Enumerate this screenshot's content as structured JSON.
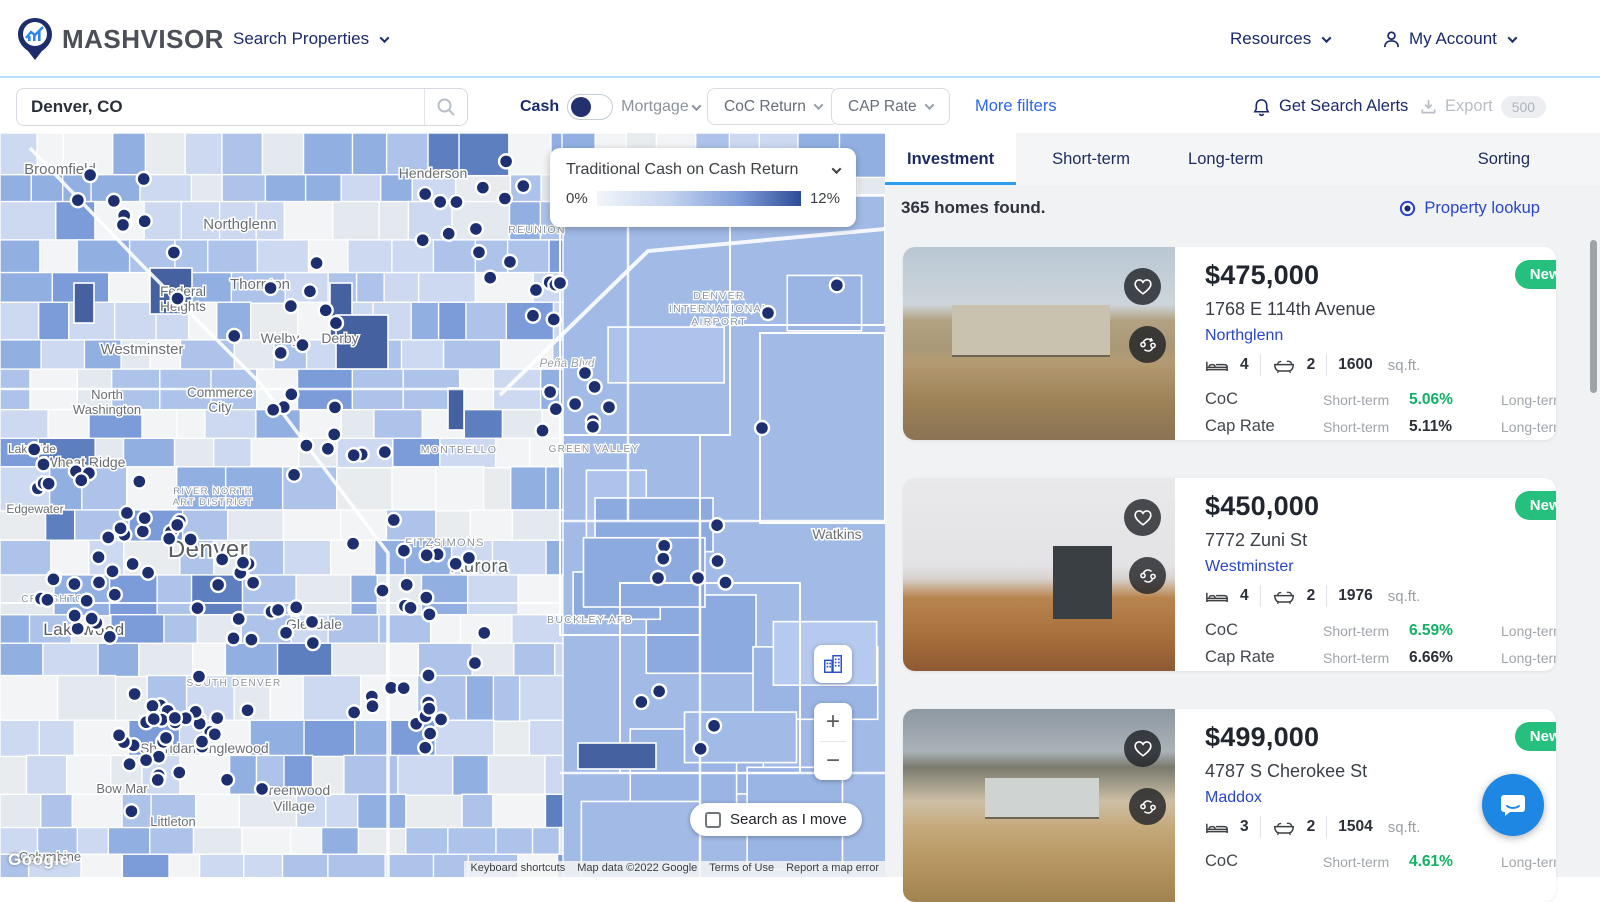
{
  "header": {
    "brand": "MASHVISOR",
    "search_properties": "Search Properties",
    "resources": "Resources",
    "my_account": "My Account"
  },
  "filters": {
    "search_value": "Denver, CO",
    "cash": "Cash",
    "mortgage": "Mortgage",
    "coc_return": "CoC Return",
    "cap_rate": "CAP Rate",
    "more_filters": "More filters",
    "get_search_alerts": "Get Search Alerts",
    "export": "Export",
    "export_count": "500"
  },
  "map": {
    "legend_title": "Traditional Cash on Cash Return",
    "legend_min": "0%",
    "legend_max": "12%",
    "search_as_i_move": "Search as I move",
    "zoom_in": "+",
    "zoom_out": "−",
    "google": "Google",
    "attribution": [
      "Keyboard shortcuts",
      "Map data ©2022 Google",
      "Terms of Use",
      "Report a map error"
    ],
    "labels": [
      {
        "t": "Broomfield",
        "x": 60,
        "y": 41,
        "s": 15,
        "k": "city"
      },
      {
        "t": "Henderson",
        "x": 433,
        "y": 45,
        "s": 14,
        "k": "city"
      },
      {
        "t": "REUNION",
        "x": 537,
        "y": 100,
        "s": 10.5,
        "k": "caps"
      },
      {
        "t": "Northglenn",
        "x": 240,
        "y": 96,
        "s": 15,
        "k": "city"
      },
      {
        "t": "Thornton",
        "x": 260,
        "y": 156,
        "s": 15,
        "k": "city"
      },
      {
        "t": "Federal",
        "x": 183,
        "y": 163,
        "s": 13.5,
        "k": "city"
      },
      {
        "t": "Heights",
        "x": 183,
        "y": 178,
        "s": 13.5,
        "k": "city"
      },
      {
        "t": "Welby",
        "x": 280,
        "y": 210,
        "s": 14,
        "k": "city"
      },
      {
        "t": "Derby",
        "x": 340,
        "y": 210,
        "s": 14,
        "k": "city"
      },
      {
        "t": "Westminster",
        "x": 142,
        "y": 221,
        "s": 15,
        "k": "city"
      },
      {
        "t": "North",
        "x": 107,
        "y": 266,
        "s": 13,
        "k": "city"
      },
      {
        "t": "Washington",
        "x": 107,
        "y": 281,
        "s": 13,
        "k": "city"
      },
      {
        "t": "Commerce",
        "x": 220,
        "y": 264,
        "s": 13.5,
        "k": "city"
      },
      {
        "t": "City",
        "x": 220,
        "y": 279,
        "s": 13.5,
        "k": "city"
      },
      {
        "t": "Wheat Ridge",
        "x": 85,
        "y": 334,
        "s": 14,
        "k": "city"
      },
      {
        "t": "Lakeside",
        "x": 32,
        "y": 320,
        "s": 12,
        "k": "city"
      },
      {
        "t": "Edgewater",
        "x": 35,
        "y": 380,
        "s": 12,
        "k": "city"
      },
      {
        "t": "MONTBELLO",
        "x": 459,
        "y": 320,
        "s": 10.5,
        "k": "caps"
      },
      {
        "t": "DENVER",
        "x": 719,
        "y": 166,
        "s": 10.5,
        "k": "dia"
      },
      {
        "t": "INTERNATIONAL",
        "x": 719,
        "y": 179,
        "s": 10.5,
        "k": "dia"
      },
      {
        "t": "AIRPORT",
        "x": 719,
        "y": 192,
        "s": 10.5,
        "k": "dia"
      },
      {
        "t": "Peña Blvd",
        "x": 567,
        "y": 234,
        "s": 11.5,
        "k": "road"
      },
      {
        "t": "GREEN VALLEY",
        "x": 594,
        "y": 319,
        "s": 10,
        "k": "caps"
      },
      {
        "t": "FITZSIMONS",
        "x": 445,
        "y": 413,
        "s": 11,
        "k": "caps"
      },
      {
        "t": "Aurora",
        "x": 480,
        "y": 439,
        "s": 18,
        "k": "big"
      },
      {
        "t": "Watkins",
        "x": 837,
        "y": 406,
        "s": 14,
        "k": "city"
      },
      {
        "t": "Denver",
        "x": 208,
        "y": 424,
        "s": 24,
        "k": "big"
      },
      {
        "t": "RIVER NORTH",
        "x": 213,
        "y": 361,
        "s": 9.5,
        "k": "caps"
      },
      {
        "t": "ART DISTRICT",
        "x": 213,
        "y": 372,
        "s": 9.5,
        "k": "caps"
      },
      {
        "t": "Glendale",
        "x": 314,
        "y": 496,
        "s": 14,
        "k": "city"
      },
      {
        "t": "BUCKLEY AFB",
        "x": 590,
        "y": 490,
        "s": 10.5,
        "k": "caps"
      },
      {
        "t": "CREIGHTON",
        "x": 57,
        "y": 469,
        "s": 10,
        "k": "caps"
      },
      {
        "t": "Lakewood",
        "x": 84,
        "y": 502,
        "s": 17,
        "k": "big"
      },
      {
        "t": "SOUTH DENVER",
        "x": 234,
        "y": 553,
        "s": 10,
        "k": "caps"
      },
      {
        "t": "Sheridan",
        "x": 168,
        "y": 620,
        "s": 14,
        "k": "city"
      },
      {
        "t": "Englewood",
        "x": 234,
        "y": 620,
        "s": 14,
        "k": "city"
      },
      {
        "t": "Bow Mar",
        "x": 122,
        "y": 660,
        "s": 13,
        "k": "city"
      },
      {
        "t": "Greenwood",
        "x": 294,
        "y": 662,
        "s": 14,
        "k": "city"
      },
      {
        "t": "Village",
        "x": 294,
        "y": 678,
        "s": 14,
        "k": "city"
      },
      {
        "t": "Littleton",
        "x": 173,
        "y": 693,
        "s": 13,
        "k": "city"
      },
      {
        "t": "Columbine",
        "x": 50,
        "y": 728,
        "s": 13,
        "k": "city"
      }
    ]
  },
  "panel": {
    "tabs": [
      {
        "label": "Investment"
      },
      {
        "label": "Short-term"
      },
      {
        "label": "Long-term"
      }
    ],
    "sorting": "Sorting",
    "results_count": "365 homes found.",
    "property_lookup": "Property lookup",
    "listings": [
      {
        "price": "$475,000",
        "badge": "New Listing",
        "address": "1768 E 114th Avenue",
        "city": "Northglenn",
        "beds": "4",
        "baths": "2",
        "sqft": "1600",
        "sqft_unit": "sq.ft.",
        "metrics": [
          {
            "label": "CoC",
            "short_label": "Short-term",
            "short": "5.06%",
            "long_label": "Long-term",
            "long": "4.94%"
          },
          {
            "label": "Cap Rate",
            "short_label": "Short-term",
            "short": "5.11%",
            "long_label": "Long-term",
            "long": "4.99%"
          }
        ]
      },
      {
        "price": "$450,000",
        "badge": "New Listing",
        "address": "7772 Zuni St",
        "city": "Westminster",
        "beds": "4",
        "baths": "2",
        "sqft": "1976",
        "sqft_unit": "sq.ft.",
        "metrics": [
          {
            "label": "CoC",
            "short_label": "Short-term",
            "short": "6.59%",
            "long_label": "Long-term",
            "long": "4.82%"
          },
          {
            "label": "Cap Rate",
            "short_label": "Short-term",
            "short": "6.66%",
            "long_label": "Long-term",
            "long": "4.87%"
          }
        ]
      },
      {
        "price": "$499,000",
        "badge": "New Listing",
        "address": "4787 S Cherokee St",
        "city": "Maddox",
        "beds": "3",
        "baths": "2",
        "sqft": "1504",
        "sqft_unit": "sq.ft.",
        "metrics": [
          {
            "label": "CoC",
            "short_label": "Short-term",
            "short": "4.61%",
            "long_label": "Long-term",
            "long": "2.68%"
          }
        ]
      }
    ]
  },
  "colors": {
    "navy": "#1b2a6b",
    "link_blue": "#2946c8",
    "accent_blue": "#2e9df0",
    "badge_green": "#25c07d",
    "value_green": "#10b166",
    "dot_navy": "#1d2f6e"
  }
}
